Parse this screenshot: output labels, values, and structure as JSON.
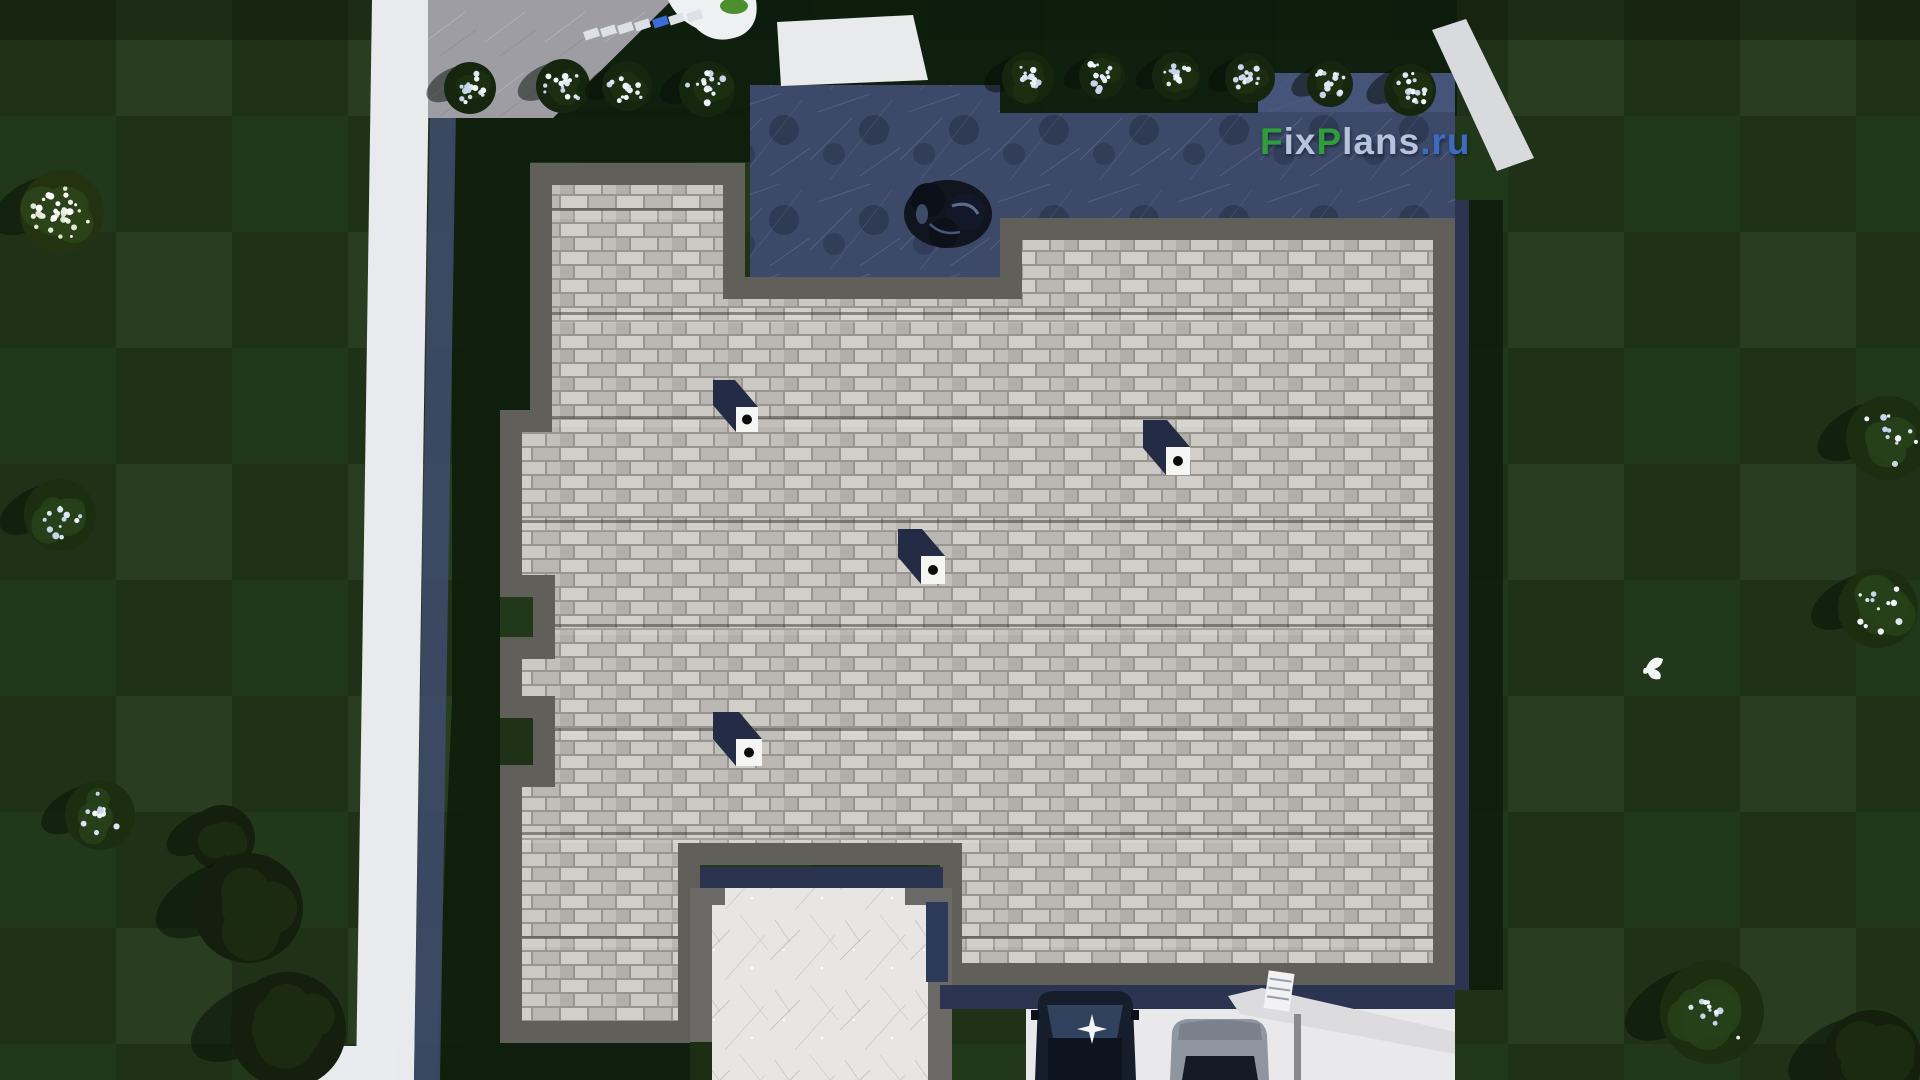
{
  "watermark": {
    "full_text": "FixPlans.ru",
    "parts": [
      {
        "text": "F",
        "color": "#2f9e3a"
      },
      {
        "text": "ix",
        "color": "#b7c3dd"
      },
      {
        "text": "P",
        "color": "#2f9e3a"
      },
      {
        "text": "lans",
        "color": "#b7c3dd"
      },
      {
        "text": ".ru",
        "color": "#3e6bc0"
      }
    ]
  },
  "palette": {
    "lawn_green": "#22381a",
    "shadow_grass": "#0d1c0c",
    "sidewalk_white": "#e9eaed",
    "sidewalk_shadow_navy": "#3d4a68",
    "driveway_gray": "#9d9da3",
    "terrace_navy": "#3c4969",
    "roof_shingle_gray": "#c7c4c0",
    "roof_eave_gray": "#615f5a",
    "patio_white": "#e8e6e2",
    "car_dark": "#161e2c",
    "car_gray": "#9096a0",
    "bush_blossom": "#dce6f4"
  },
  "scene": {
    "view": "aerial top-down 3D render of house roof and yard",
    "roof_vents": 4,
    "cars": 2,
    "flowering_bushes": 10,
    "trees": 9,
    "birds": 1,
    "surfaces": [
      "lawn",
      "sidewalk",
      "driveway",
      "paved terrace",
      "shingle roof",
      "white patio"
    ]
  }
}
